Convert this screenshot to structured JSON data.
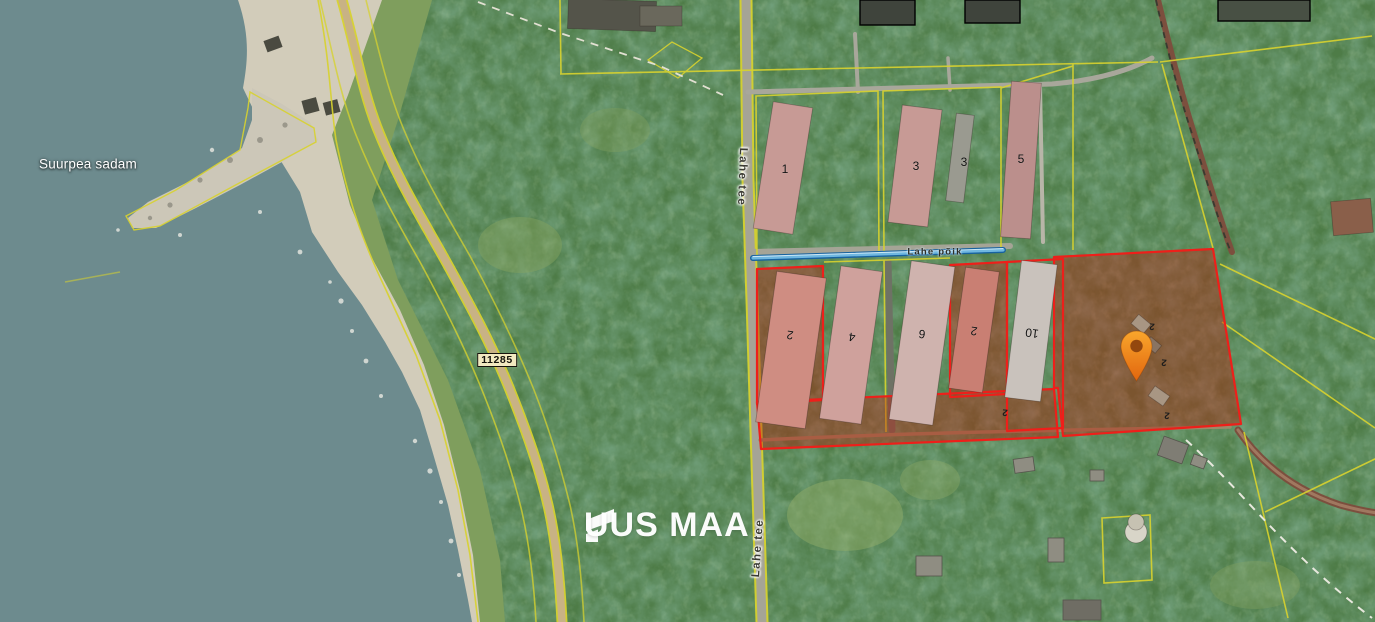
{
  "map": {
    "place_label": "Suurpea sadam",
    "road_badge": "11285",
    "road_name_top": "Lahe tee",
    "road_name_bottom": "Lahe tee",
    "side_street": "Lahe põik",
    "watermark": "UUS MAA",
    "buildings": {
      "top": [
        "1",
        "3",
        "3",
        "5"
      ],
      "middle": [
        "2",
        "4",
        "6",
        "2",
        "10"
      ],
      "marks": [
        "2",
        "2",
        "2",
        "2"
      ]
    },
    "colors": {
      "water": "#6d8b8e",
      "sand": "#d2ccba",
      "forest": "#4e7c47",
      "cadastral_line": "#d7d22f",
      "highlight_outline": "#ee1f1a",
      "highlight_fill": "rgba(185,32,14,0.42)",
      "pin_orange": "#f07d1e",
      "road_tan": "#c8b285",
      "blue_line": "#2d7fbc"
    }
  }
}
